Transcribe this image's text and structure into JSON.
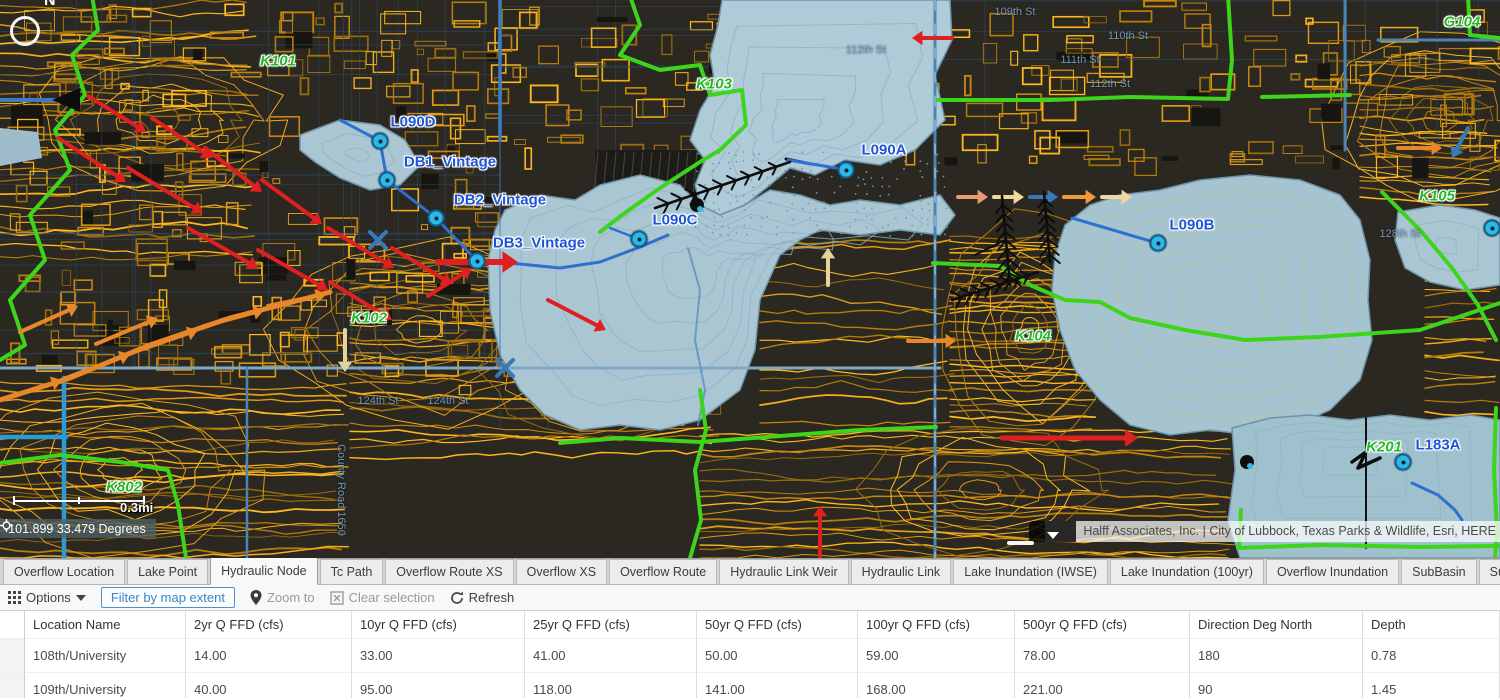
{
  "map": {
    "scale_label": "0.3mi",
    "coordinates": "-101.899 33.479 Degrees",
    "attribution": "Halff Associates, Inc. | City of Lubbock, Texas Parks & Wildlife, Esri, HERE",
    "compass_letter": "N",
    "icons": {
      "compass": "compass-ring-icon",
      "coordinates": "crosshair-icon",
      "attribution_toggle": "chevron-down-icon",
      "options": "grid-icon",
      "options_caret": "caret-down-icon",
      "zoom_to": "map-pin-icon",
      "clear_selection": "x-box-icon",
      "refresh": "refresh-icon"
    },
    "basin_labels": [
      {
        "text": "K101",
        "x": 278,
        "y": 61
      },
      {
        "text": "K103",
        "x": 714,
        "y": 84
      },
      {
        "text": "G104",
        "x": 1462,
        "y": 22
      },
      {
        "text": "K105",
        "x": 1437,
        "y": 196
      },
      {
        "text": "K102",
        "x": 369,
        "y": 318
      },
      {
        "text": "K104",
        "x": 1033,
        "y": 336
      },
      {
        "text": "K802",
        "x": 124,
        "y": 487
      },
      {
        "text": "K201",
        "x": 1384,
        "y": 447
      }
    ],
    "node_labels": [
      {
        "text": "L090D",
        "x": 413,
        "y": 122
      },
      {
        "text": "DB1_Vintage",
        "x": 450,
        "y": 162
      },
      {
        "text": "DB2_Vintage",
        "x": 500,
        "y": 200
      },
      {
        "text": "DB3_Vintage",
        "x": 539,
        "y": 243
      },
      {
        "text": "L090C",
        "x": 675,
        "y": 220
      },
      {
        "text": "L090A",
        "x": 884,
        "y": 150
      },
      {
        "text": "L090B",
        "x": 1192,
        "y": 225
      },
      {
        "text": "L183A",
        "x": 1438,
        "y": 445
      }
    ],
    "street_labels": [
      {
        "text": "109th St",
        "x": 1015,
        "y": 12,
        "rot": 0
      },
      {
        "text": "110th St",
        "x": 1128,
        "y": 36,
        "rot": 0
      },
      {
        "text": "111th St",
        "x": 1080,
        "y": 60,
        "rot": 0
      },
      {
        "text": "112th St",
        "x": 1110,
        "y": 84,
        "rot": 0
      },
      {
        "text": "112th St",
        "x": 866,
        "y": 50,
        "rot": 0
      },
      {
        "text": "124th St",
        "x": 378,
        "y": 401,
        "rot": 0
      },
      {
        "text": "124th St",
        "x": 448,
        "y": 401,
        "rot": 0
      },
      {
        "text": "128th St",
        "x": 1400,
        "y": 234,
        "rot": 0
      },
      {
        "text": "County Road 1650",
        "x": 341,
        "y": 490,
        "rot": 90
      }
    ],
    "points": [
      {
        "id": "L090D",
        "x": 380,
        "y": 141
      },
      {
        "id": "DB1_Vintage",
        "x": 387,
        "y": 180
      },
      {
        "id": "DB2_Vintage",
        "x": 436,
        "y": 218
      },
      {
        "id": "DB3_Vintage",
        "x": 477,
        "y": 261
      },
      {
        "id": "L090C",
        "x": 639,
        "y": 239
      },
      {
        "id": "L090A",
        "x": 846,
        "y": 170
      },
      {
        "id": "L090B",
        "x": 1158,
        "y": 243
      },
      {
        "id": "L183A",
        "x": 1403,
        "y": 462
      },
      {
        "id": "node",
        "x": 1492,
        "y": 228
      }
    ],
    "colors": {
      "boundary_green": "#3dd41c",
      "contour_orange": "#e09b16",
      "lake_blue": "#aac6d3",
      "node_label_blue": "#1d55d8",
      "basin_label_green": "#23bb23",
      "flow_red": "#e02020"
    }
  },
  "tabs": {
    "active": "Hydraulic Node",
    "items": [
      "Overflow Location",
      "Lake Point",
      "Hydraulic Node",
      "Tc Path",
      "Overflow Route XS",
      "Overflow XS",
      "Overflow Route",
      "Hydraulic Link Weir",
      "Hydraulic Link",
      "Lake Inundation (IWSE)",
      "Lake Inundation (100yr)",
      "Overflow Inundation",
      "SubBasin",
      "SubArea"
    ]
  },
  "toolbar": {
    "options_label": "Options",
    "filter_label": "Filter by map extent",
    "zoom_to_label": "Zoom to",
    "clear_selection_label": "Clear selection",
    "refresh_label": "Refresh"
  },
  "table": {
    "headers": [
      "Location Name",
      "2yr Q FFD (cfs)",
      "10yr Q FFD (cfs)",
      "25yr Q FFD (cfs)",
      "50yr Q FFD (cfs)",
      "100yr Q FFD (cfs)",
      "500yr Q FFD (cfs)",
      "Direction Deg North",
      "Depth"
    ],
    "rows": [
      [
        "108th/University",
        "14.00",
        "33.00",
        "41.00",
        "50.00",
        "59.00",
        "78.00",
        "180",
        "0.78"
      ],
      [
        "109th/University",
        "40.00",
        "95.00",
        "118.00",
        "141.00",
        "168.00",
        "221.00",
        "90",
        "1.45"
      ]
    ]
  }
}
